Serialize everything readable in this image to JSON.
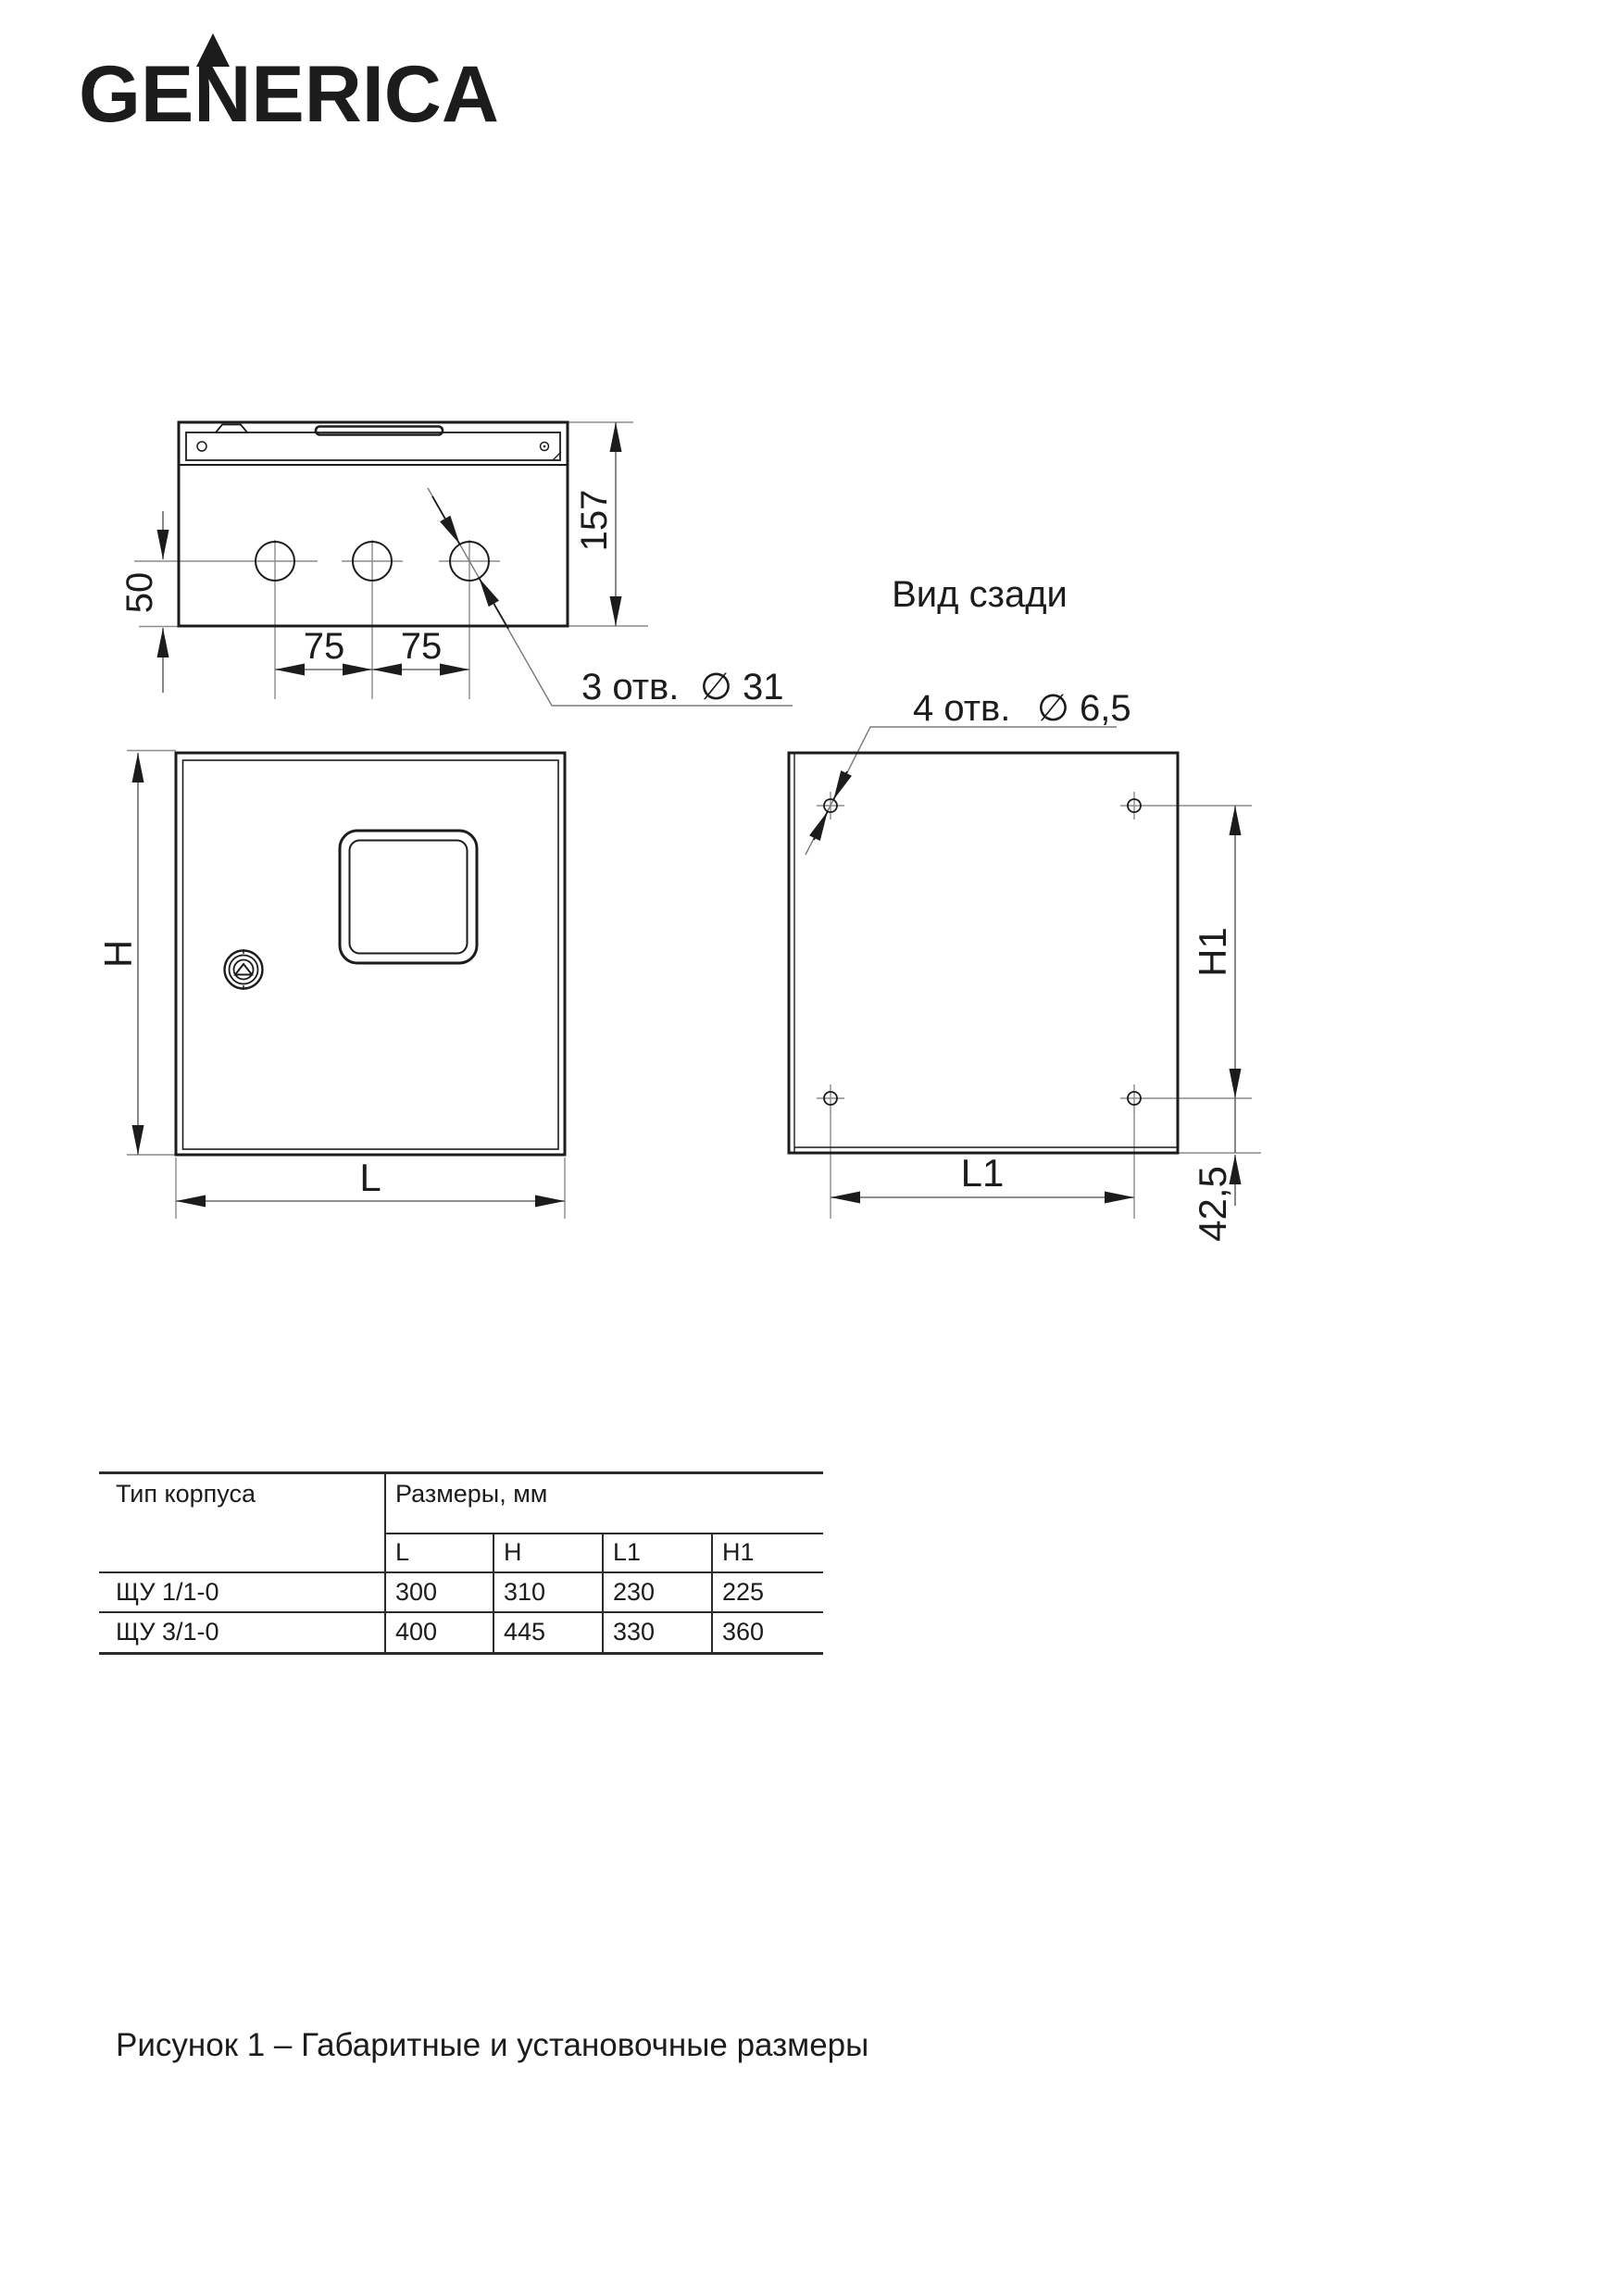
{
  "logo": {
    "text": "GENERICA"
  },
  "top_view": {
    "dim_depth": "157",
    "dim_hole_offset": "50",
    "dim_pitch_1": "75",
    "dim_pitch_2": "75",
    "holes_note": "3 отв.",
    "holes_dia": "∅ 31"
  },
  "front_view": {
    "dim_height": "H",
    "dim_width": "L"
  },
  "back_view": {
    "title": "Вид сзади",
    "holes_note": "4 отв.",
    "holes_dia": "∅ 6,5",
    "dim_height": "H1",
    "dim_width": "L1",
    "dim_bottom_offset": "42,5"
  },
  "table": {
    "header_type": "Тип корпуса",
    "header_dims": "Размеры, мм",
    "columns": [
      "L",
      "H",
      "L1",
      "H1"
    ],
    "rows": [
      {
        "type": "ЩУ 1/1-0",
        "values": [
          "300",
          "310",
          "230",
          "225"
        ]
      },
      {
        "type": "ЩУ 3/1-0",
        "values": [
          "400",
          "445",
          "330",
          "360"
        ]
      }
    ]
  },
  "caption": "Рисунок 1 – Габаритные и установочные размеры",
  "style": {
    "ink": "#1c1c1c",
    "thin_line": "#8c8c8c",
    "dim_line": "#6a6a6a",
    "background": "#ffffff"
  }
}
